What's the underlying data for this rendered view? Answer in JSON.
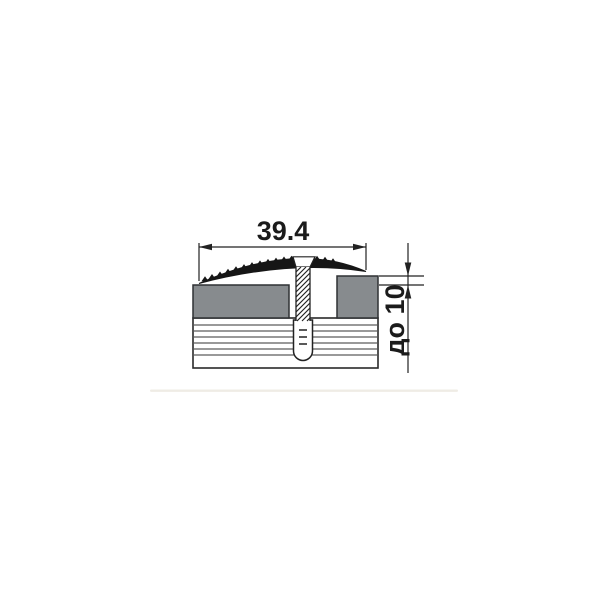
{
  "page": {
    "background": "#ffffff"
  },
  "drawing": {
    "kind": "floor-transition-profile-cross-section",
    "dimension_width": {
      "label": "39.4"
    },
    "dimension_height": {
      "label": "до 10"
    },
    "colors": {
      "line": "#222222",
      "text": "#1b1b1b",
      "profile_black": "#161616",
      "floor_covering_gray": "#878b8e",
      "background": "#ffffff"
    }
  }
}
